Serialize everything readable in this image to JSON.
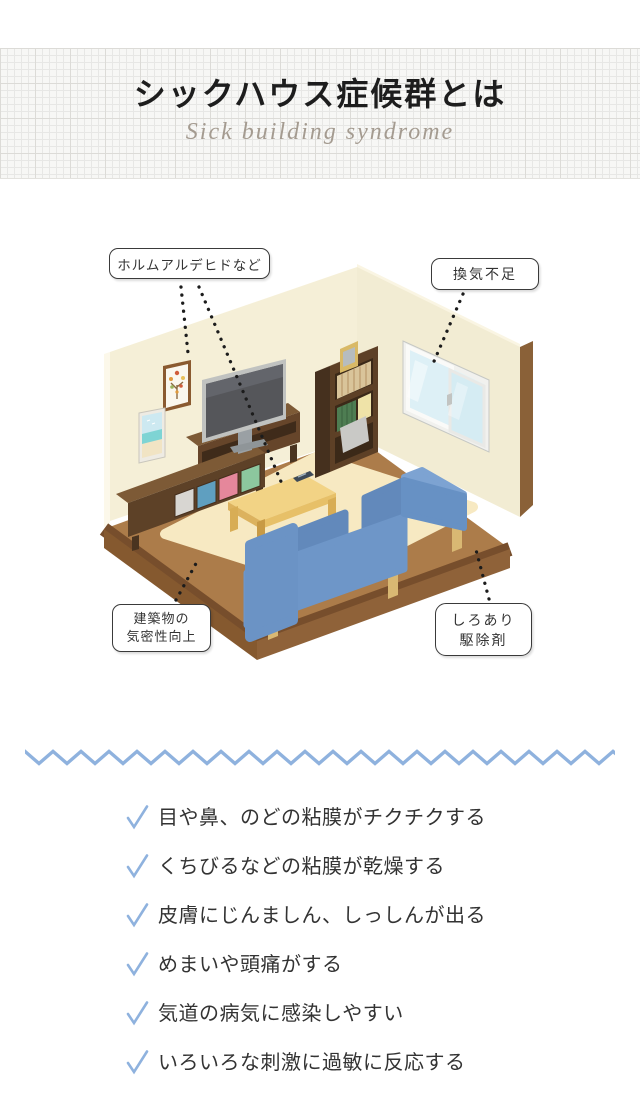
{
  "header": {
    "title": "シックハウス症候群とは",
    "subtitle": "Sick building syndrome"
  },
  "callouts": [
    {
      "text": "ホルムアルデヒドなど"
    },
    {
      "text": "換気不足"
    },
    {
      "line1": "建築物の",
      "line2": "気密性向上"
    },
    {
      "line1": "しろあり",
      "line2": "駆除剤"
    }
  ],
  "scene": {
    "description": "isometric living room",
    "items": [
      "picture-frame-tree",
      "picture-frame-beach",
      "tv",
      "tv-board",
      "sideboard",
      "bookshelf",
      "photo-frame",
      "window",
      "rug",
      "low-table",
      "remote-control",
      "sofa",
      "floor",
      "walls"
    ]
  },
  "divider": {
    "type": "zigzag",
    "color": "#8fb2de"
  },
  "symptoms": {
    "check_color": "#8fb2de",
    "items": [
      "目や鼻、のどの粘膜がチクチクする",
      "くちびるなどの粘膜が乾燥する",
      "皮膚にじんましん、しっしんが出る",
      "めまいや頭痛がする",
      "気道の病気に感染しやすい",
      "いろいろな刺激に過敏に反応する"
    ]
  },
  "colors": {
    "wall": "#f5efd7",
    "wall_edge": "#8a6138",
    "floor": "#ac7c4a",
    "floor_border": "#774e2c",
    "rug": "#f7e9c2",
    "sofa": "#6e96c8",
    "table": "#f2d385",
    "wood_dark": "#5d4127",
    "window_glass": "#e2f3f7",
    "title_text": "#1d1d1d",
    "subtitle_text": "#a49b90",
    "body_text": "#333333"
  }
}
